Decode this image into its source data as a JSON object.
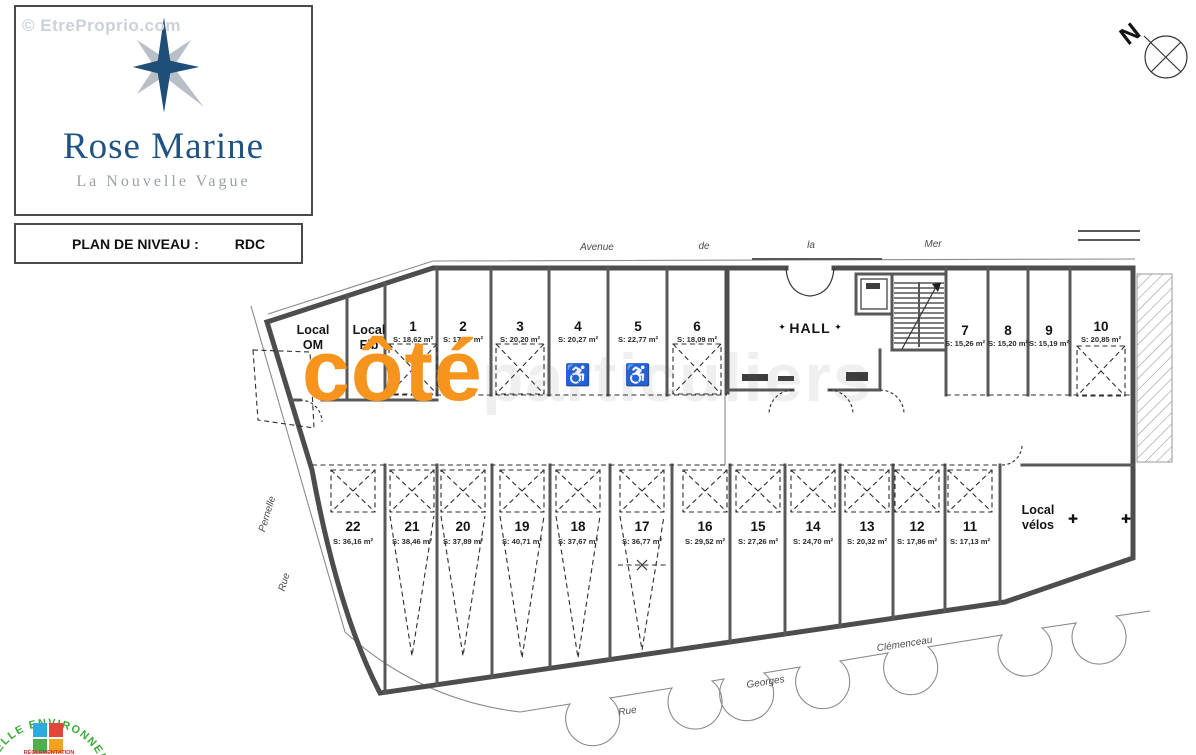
{
  "watermarks": {
    "site": "© EtreProprio.com",
    "brand": "côté",
    "brand_ghost": "particuliers"
  },
  "logo": {
    "title": "Rose Marine",
    "subtitle": "La Nouvelle Vague"
  },
  "plan_header": {
    "label": "PLAN DE NIVEAU :",
    "value": "RDC"
  },
  "compass": {
    "label": "N"
  },
  "streets": {
    "top": [
      "Avenue",
      "de",
      "la",
      "Mer"
    ],
    "bottom": [
      "Rue",
      "Georges",
      "Clémenceau"
    ],
    "left": {
      "name": "Pernelle",
      "rue": "Rue"
    }
  },
  "rooms": {
    "om_line1": "Local",
    "om_line2": "OM",
    "fib_line1": "Local",
    "fib_line2": "Fib",
    "hall": "HALL",
    "velos_line1": "Local",
    "velos_line2": "vélos"
  },
  "icons": {
    "wheelchair": "♿",
    "diamond": "✦",
    "rack": "✚"
  },
  "spaces": [
    {
      "num": "1",
      "area": "S: 18,62 m²"
    },
    {
      "num": "2",
      "area": "S: 17,67 m²"
    },
    {
      "num": "3",
      "area": "S: 20,20 m²"
    },
    {
      "num": "4",
      "area": "S: 20,27 m²"
    },
    {
      "num": "5",
      "area": "S: 22,77 m²"
    },
    {
      "num": "6",
      "area": "S: 18,09 m²"
    },
    {
      "num": "7",
      "area": "S: 15,26 m²"
    },
    {
      "num": "8",
      "area": "S: 15,20 m²"
    },
    {
      "num": "9",
      "area": "S: 15,19 m²"
    },
    {
      "num": "10",
      "area": "S: 20,85 m²"
    },
    {
      "num": "11",
      "area": "S: 17,13 m²"
    },
    {
      "num": "12",
      "area": "S: 17,86 m²"
    },
    {
      "num": "13",
      "area": "S: 20,32 m²"
    },
    {
      "num": "14",
      "area": "S: 24,70 m²"
    },
    {
      "num": "15",
      "area": "S: 27,26 m²"
    },
    {
      "num": "16",
      "area": "S: 29,52 m²"
    },
    {
      "num": "17",
      "area": "S: 36,77 m²"
    },
    {
      "num": "18",
      "area": "S: 37,67 m²"
    },
    {
      "num": "19",
      "area": "S: 40,71 m²"
    },
    {
      "num": "20",
      "area": "S: 37,89 m²"
    },
    {
      "num": "21",
      "area": "S: 38,46 m²"
    },
    {
      "num": "22",
      "area": "S: 36,16 m²"
    }
  ],
  "eco": {
    "arc": "NELLE ENVIRONNEM",
    "sub": "RÉGLEMENTATION"
  },
  "colors": {
    "accent_orange": "#F7941E",
    "logo_blue": "#1F4E79",
    "star_gray": "#B9BFC7",
    "eco_green": "#3AAA35",
    "wall_gray": "#4D4D4D"
  }
}
